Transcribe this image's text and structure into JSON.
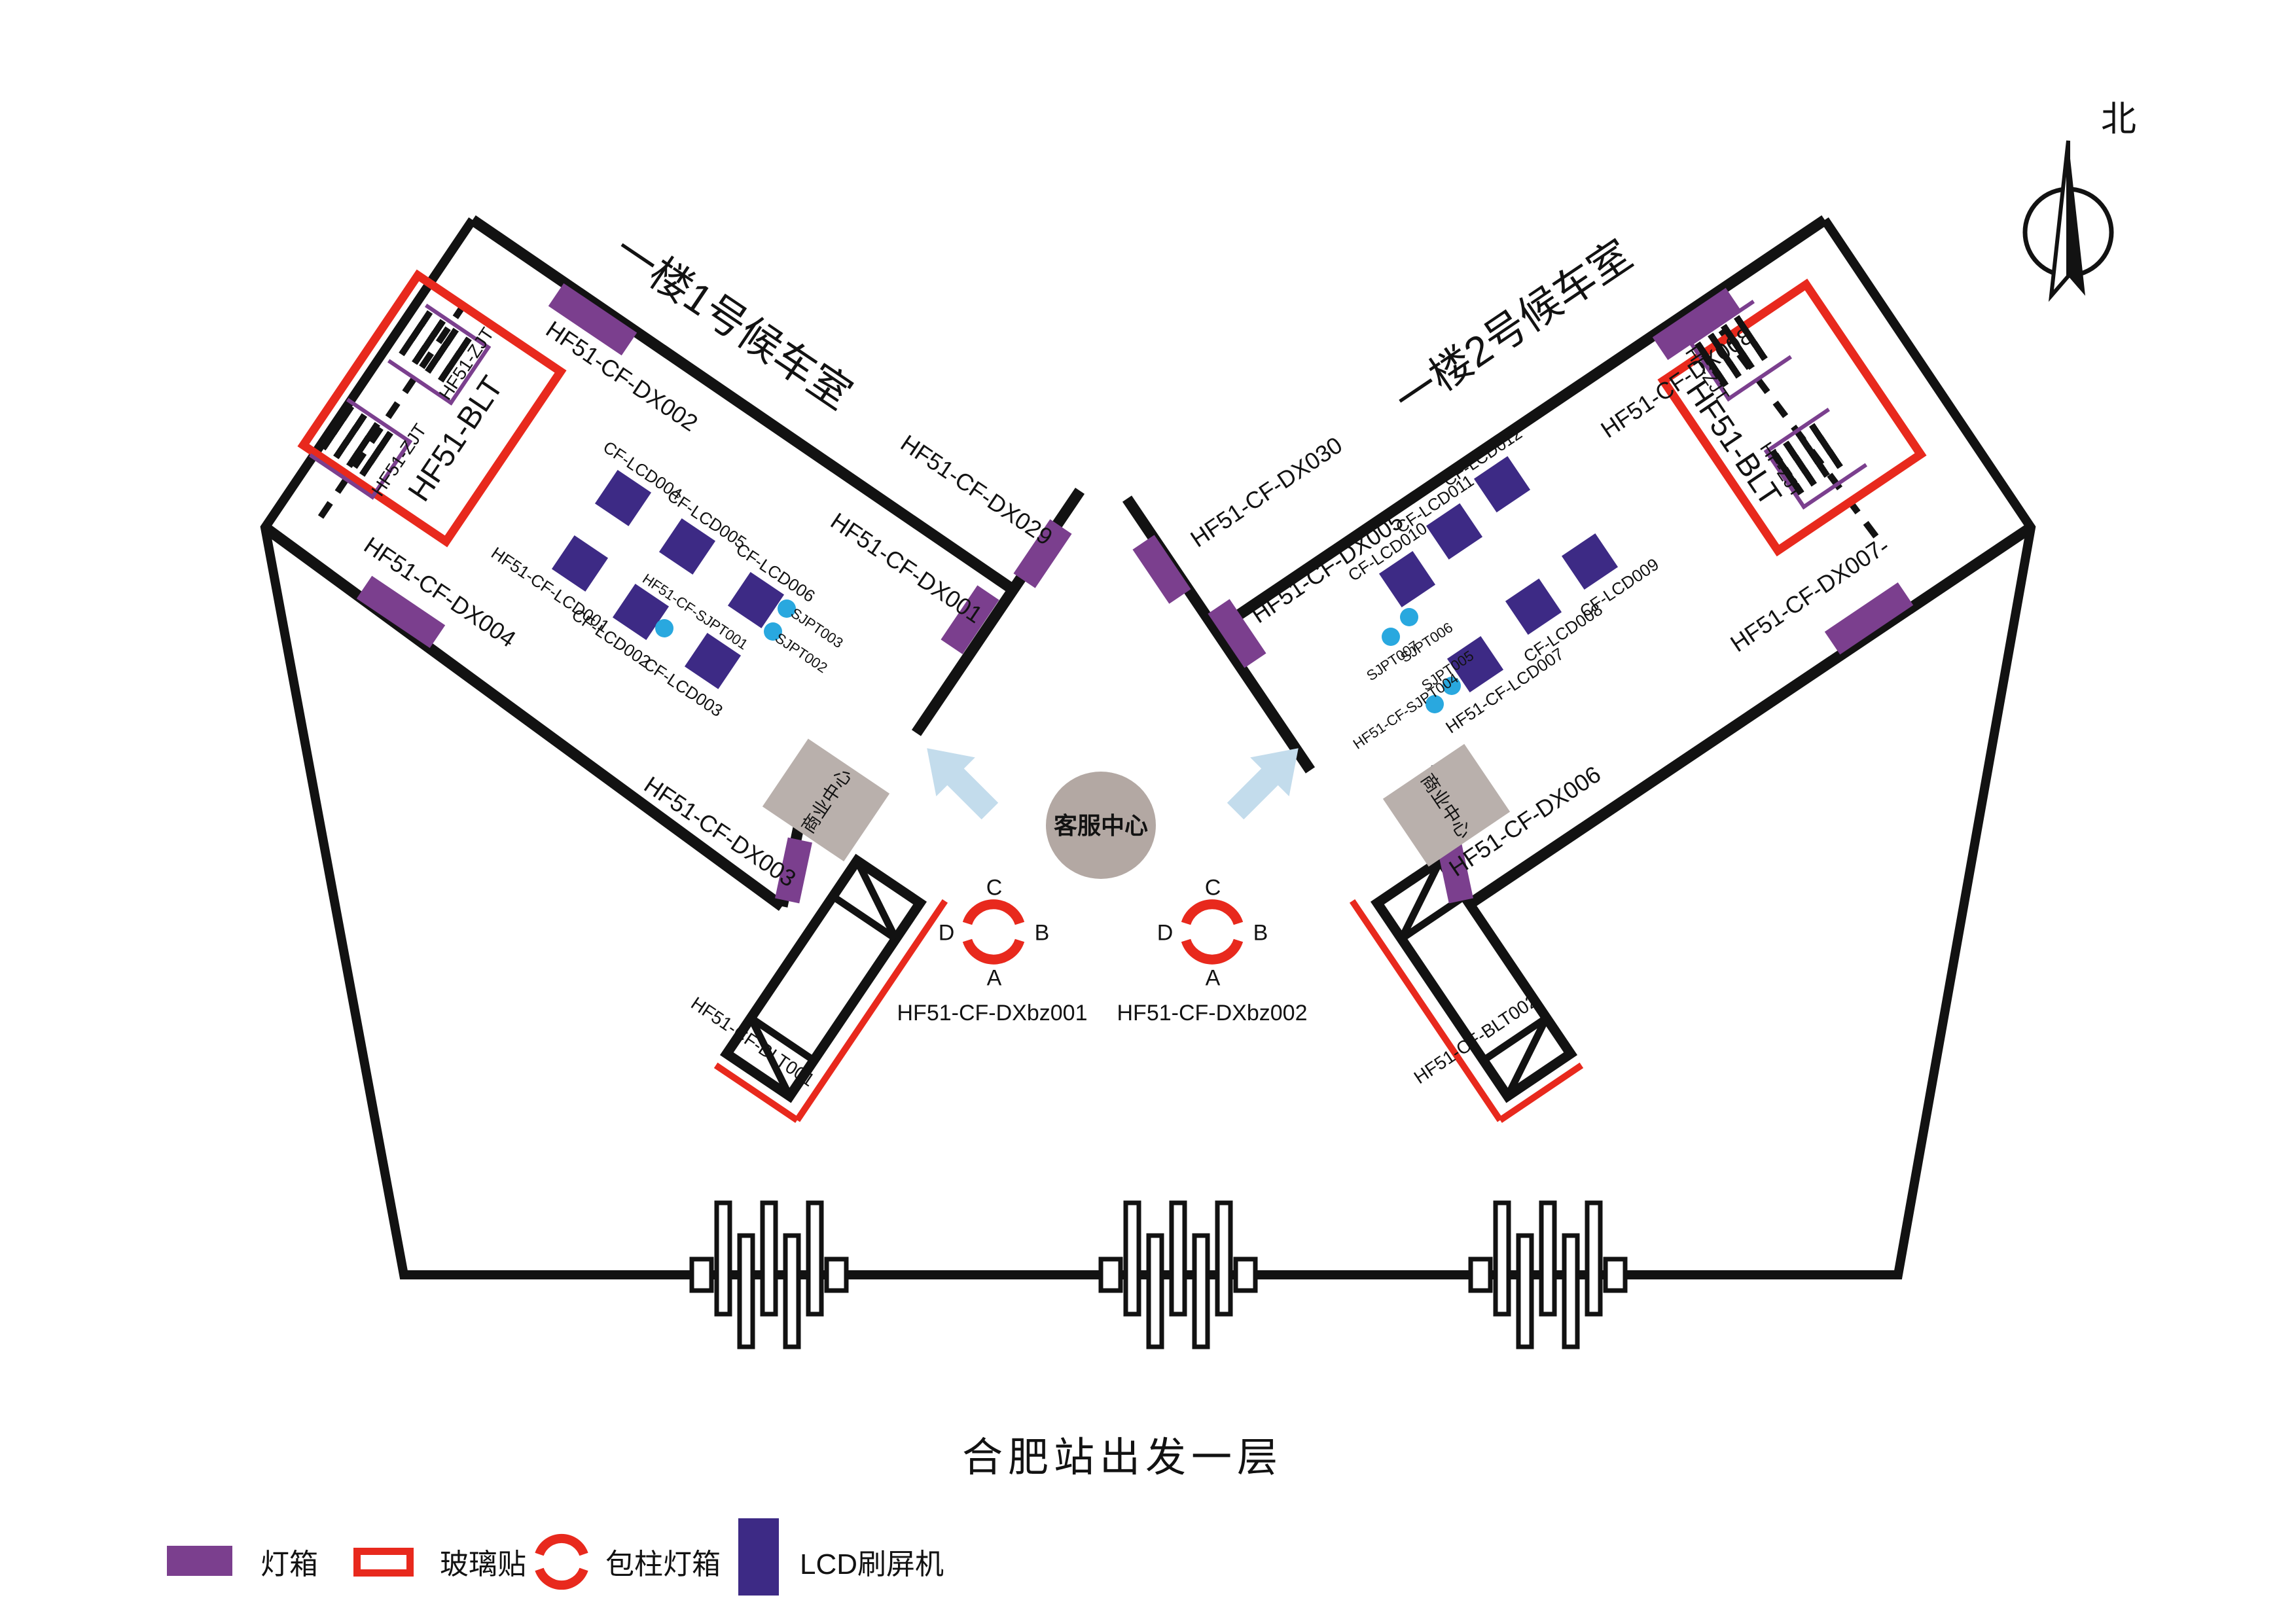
{
  "title": "合肥站出发一层",
  "compass": "北",
  "legend": {
    "lightbox": "灯箱",
    "glass": "玻璃贴",
    "column": "包柱灯箱",
    "lcd": "LCD刷屏机"
  },
  "center": {
    "service": "客服中心",
    "pillar1": "HF51-CF-DXbz001",
    "pillar2": "HF51-CF-DXbz002",
    "dir_top": "C",
    "dir_right": "B",
    "dir_bottom": "A",
    "dir_left": "D"
  },
  "left": {
    "name": "一楼1号候车室",
    "dx002": "HF51-CF-DX002",
    "dx004": "HF51-CF-DX004",
    "dx029": "HF51-CF-DX029",
    "dx001": "HF51-CF-DX001",
    "dx003": "HF51-CF-DX003",
    "blt": "HF51-BLT",
    "zjt1": "HF51-ZJT",
    "zjt2": "HF51-ZJT",
    "lcd004": "CF-LCD004",
    "lcd005": "CF-LCD005",
    "lcd006": "CF-LCD006",
    "lcd001": "HF51-CF-LCD001",
    "lcd002": "CF-LCD002",
    "lcd003": "CF-LCD003",
    "sjpt001": "HF51-CF-SJPT001",
    "sjpt002": "SJPT002",
    "sjpt003": "SJPT003",
    "shop": "商业中心",
    "escalator": "HF51-CF-BLT001"
  },
  "right": {
    "name": "一楼2号候车室",
    "dx008": "HF51-CF-DX008",
    "dx030": "HF51-CF-DX030",
    "dx005": "HF51-CF-DX005",
    "dx007": "HF51-CF-DX007",
    "dx006": "HF51-CF-DX006",
    "blt": "HF51-BLT",
    "zjt1": "HF-ZJT",
    "zjt2": "HF-ZJT",
    "lcd010": "CF-LCD010",
    "lcd011": "CF-LCD011",
    "lcd012": "CF-LCD012",
    "lcd007": "HF51-CF-LCD007",
    "lcd008": "CF-LCD008",
    "lcd009": "CF-LCD009",
    "sjpt004": "HF51-CF-SJPT004",
    "sjpt005": "SJPT005",
    "sjpt006": "SJPT006",
    "sjpt007": "SJPT007",
    "shop": "商业中心",
    "escalator": "HF51-CF-BLT002"
  },
  "colors": {
    "lightbox_purple": "#7b3f8e",
    "glass_red": "#e8291d",
    "lcd_indigo": "#3d2a85",
    "sjpt_cyan": "#29a8df",
    "shop_gray": "#b9b0ac",
    "service_gray": "#b3a8a3",
    "arrow_blue": "#c3dcec",
    "line_black": "#121212"
  }
}
